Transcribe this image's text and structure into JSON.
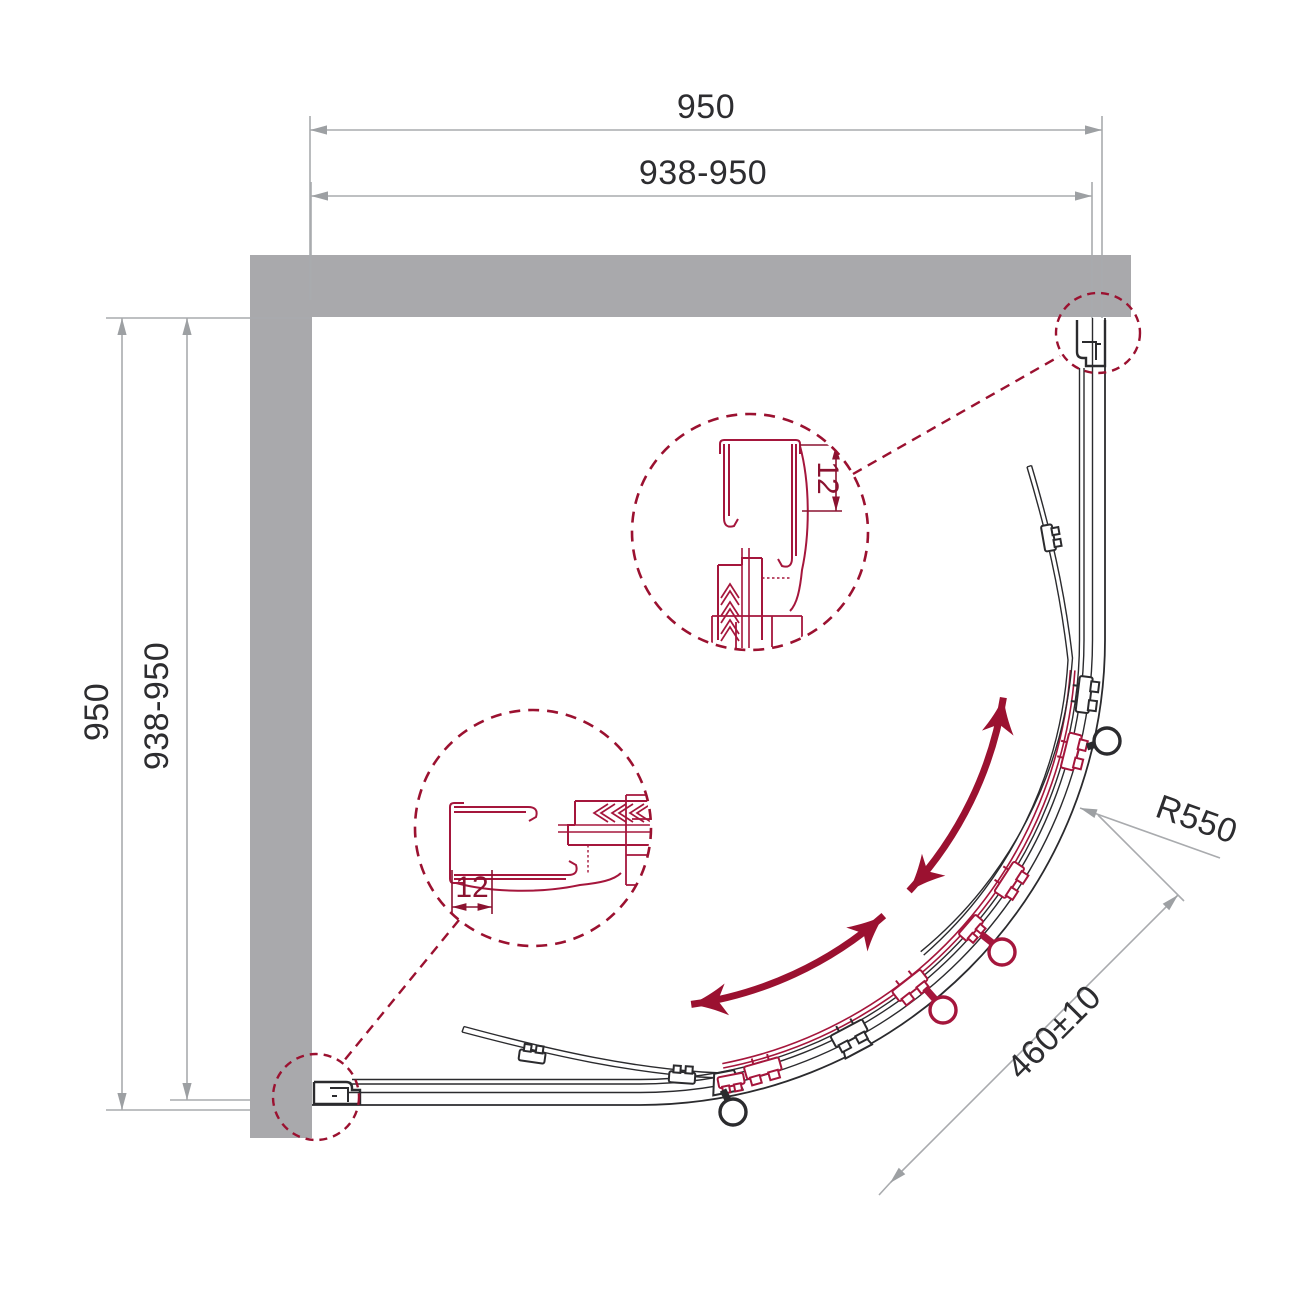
{
  "diagram": {
    "type": "shower-enclosure-quadrant-top-view",
    "colors": {
      "wall": "#a9a9ac",
      "drawing_line": "#2b2b2e",
      "dimension_line": "#a9abae",
      "accent_dark": "#9b1130",
      "accent_line": "#a5163c"
    },
    "dims": {
      "top_outer": "950",
      "top_range": "938-950",
      "left_outer": "950",
      "left_range": "938-950",
      "radius": "R550",
      "entry_width": "460±10",
      "profile_detail_top": "12",
      "profile_detail_side": "12"
    }
  }
}
